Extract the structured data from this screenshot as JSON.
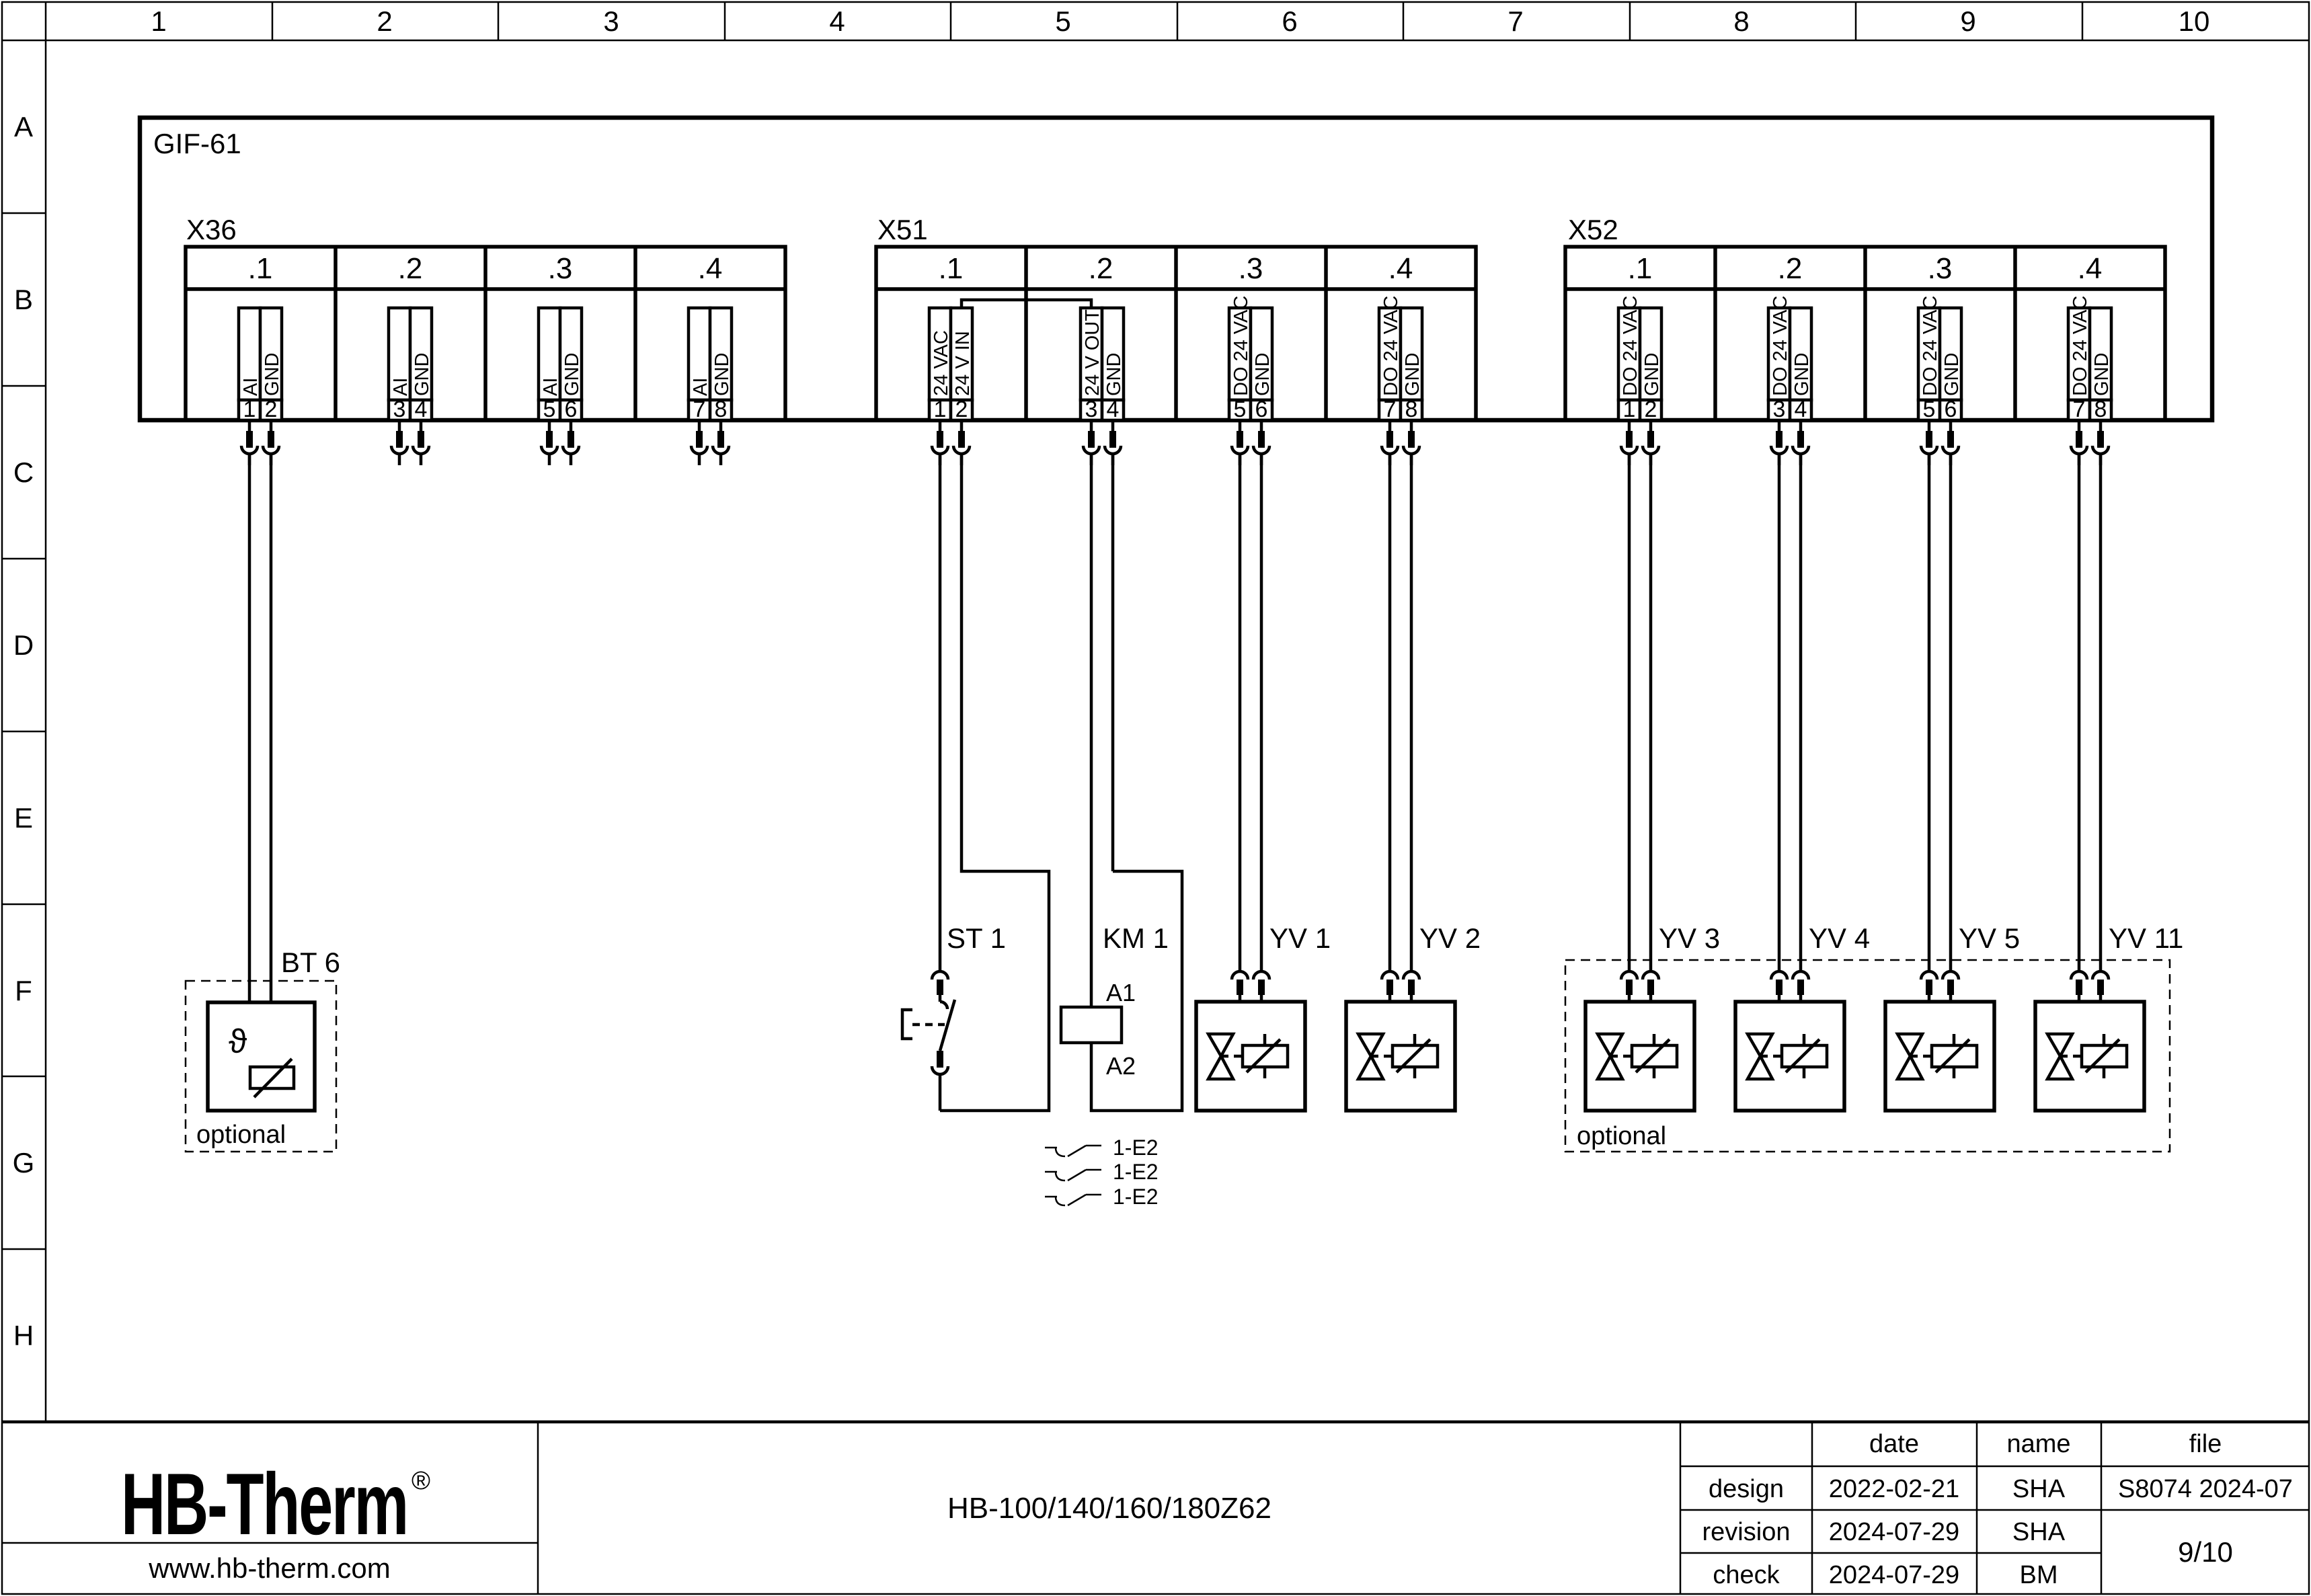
{
  "ruler": {
    "columns": [
      "1",
      "2",
      "3",
      "4",
      "5",
      "6",
      "7",
      "8",
      "9",
      "10"
    ],
    "rows": [
      "A",
      "B",
      "C",
      "D",
      "E",
      "F",
      "G",
      "H"
    ]
  },
  "module": {
    "label": "GIF-61"
  },
  "connectors": [
    {
      "label": "X36",
      "cells": [
        {
          "label": ".1",
          "pins": [
            {
              "num": "1",
              "label": "AI"
            },
            {
              "num": "2",
              "label": "GND"
            }
          ]
        },
        {
          "label": ".2",
          "pins": [
            {
              "num": "3",
              "label": "AI"
            },
            {
              "num": "4",
              "label": "GND"
            }
          ]
        },
        {
          "label": ".3",
          "pins": [
            {
              "num": "5",
              "label": "AI"
            },
            {
              "num": "6",
              "label": "GND"
            }
          ]
        },
        {
          "label": ".4",
          "pins": [
            {
              "num": "7",
              "label": "AI"
            },
            {
              "num": "8",
              "label": "GND"
            }
          ]
        }
      ]
    },
    {
      "label": "X51",
      "cells": [
        {
          "label": ".1",
          "pins": [
            {
              "num": "1",
              "label": "24 VAC"
            },
            {
              "num": "2",
              "label": "24 V IN"
            }
          ]
        },
        {
          "label": ".2",
          "pins": [
            {
              "num": "3",
              "label": "24 V OUT"
            },
            {
              "num": "4",
              "label": "GND"
            }
          ]
        },
        {
          "label": ".3",
          "pins": [
            {
              "num": "5",
              "label": "DO 24 VAC"
            },
            {
              "num": "6",
              "label": "GND"
            }
          ]
        },
        {
          "label": ".4",
          "pins": [
            {
              "num": "7",
              "label": "DO 24 VAC"
            },
            {
              "num": "8",
              "label": "GND"
            }
          ]
        }
      ]
    },
    {
      "label": "X52",
      "cells": [
        {
          "label": ".1",
          "pins": [
            {
              "num": "1",
              "label": "DO 24 VAC"
            },
            {
              "num": "2",
              "label": "GND"
            }
          ]
        },
        {
          "label": ".2",
          "pins": [
            {
              "num": "3",
              "label": "DO 24 VAC"
            },
            {
              "num": "4",
              "label": "GND"
            }
          ]
        },
        {
          "label": ".3",
          "pins": [
            {
              "num": "5",
              "label": "DO 24 VAC"
            },
            {
              "num": "6",
              "label": "GND"
            }
          ]
        },
        {
          "label": ".4",
          "pins": [
            {
              "num": "7",
              "label": "DO 24 VAC"
            },
            {
              "num": "8",
              "label": "GND"
            }
          ]
        }
      ]
    }
  ],
  "components": {
    "bt6": {
      "label": "BT 6",
      "theta": "ϑ",
      "note": "optional"
    },
    "st1": {
      "label": "ST 1"
    },
    "km1": {
      "label": "KM 1",
      "a1": "A1",
      "a2": "A2"
    },
    "valves": [
      {
        "label": "YV 1"
      },
      {
        "label": "YV 2"
      },
      {
        "label": "YV 3"
      },
      {
        "label": "YV 4"
      },
      {
        "label": "YV 5"
      },
      {
        "label": "YV 11"
      }
    ],
    "optional_group": {
      "note": "optional"
    },
    "aux_contacts": [
      {
        "label": "1-E2"
      },
      {
        "label": "1-E2"
      },
      {
        "label": "1-E2"
      }
    ]
  },
  "title_block": {
    "logo": {
      "text": "HB-Therm",
      "registered": "®",
      "color": "#212b52"
    },
    "website": "www.hb-therm.com",
    "doc_title": "HB-100/140/160/180Z62",
    "table": {
      "date_header": "date",
      "name_header": "name",
      "file_header": "file",
      "rows": [
        {
          "label": "design",
          "date": "2022-02-21",
          "name": "SHA"
        },
        {
          "label": "revision",
          "date": "2024-07-29",
          "name": "SHA"
        },
        {
          "label": "check",
          "date": "2024-07-29",
          "name": "BM"
        }
      ],
      "file_value": "S8074 2024-07",
      "page": "9/10"
    }
  }
}
